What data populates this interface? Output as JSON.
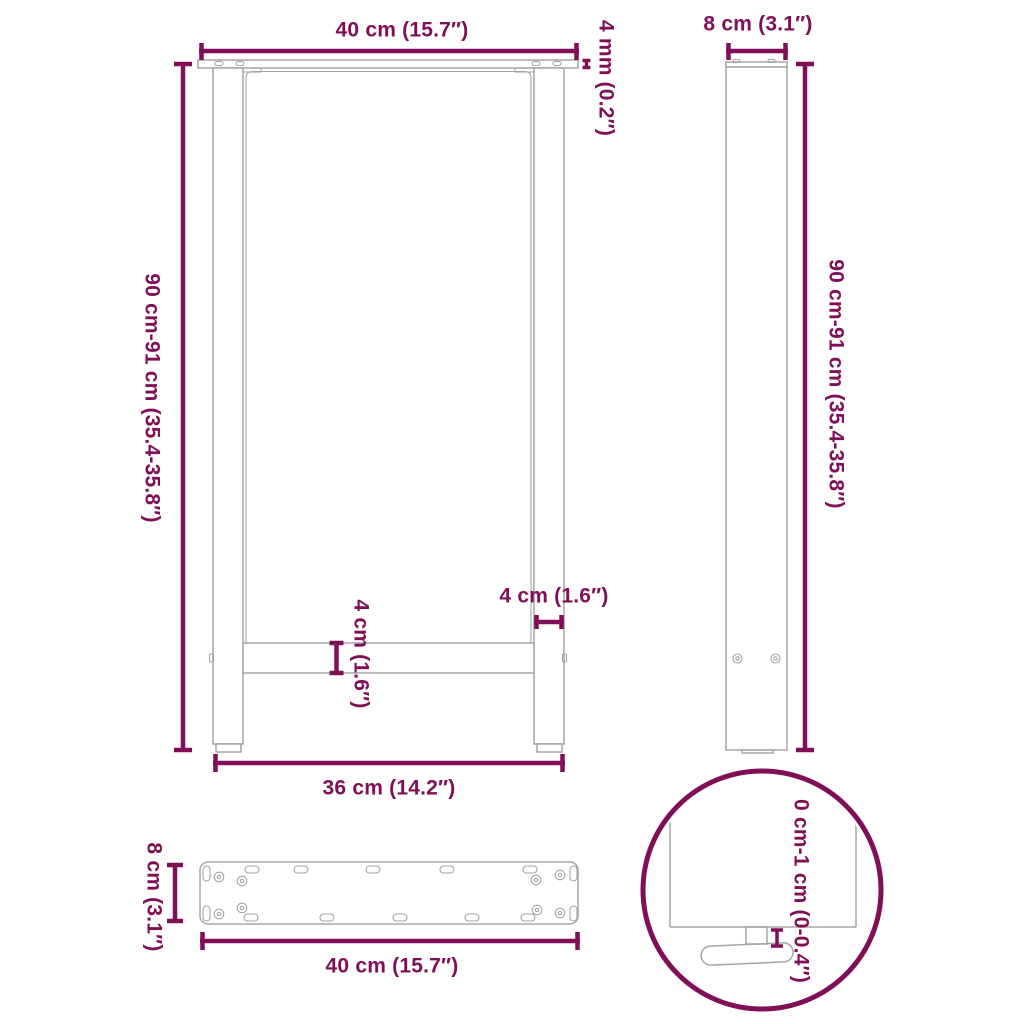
{
  "colors": {
    "accent": "#800F58",
    "outline": "#A5A5A5",
    "background": "#FFFFFF"
  },
  "views": {
    "front": {
      "labels": {
        "top_width": "40 cm (15.7″)",
        "plate_thickness": "4 mm (0.2″)",
        "height_range": "90 cm-91 cm (35.4-35.8″)",
        "leg_width": "4 cm (1.6″)",
        "crossbar_height": "4 cm (1.6″)",
        "bottom_width": "36 cm (14.2″)"
      }
    },
    "side": {
      "labels": {
        "depth": "8 cm (3.1″)",
        "height_range": "90 cm-91 cm (35.4-35.8″)"
      }
    },
    "mounting_plate": {
      "labels": {
        "depth": "8 cm (3.1″)",
        "width": "40 cm (15.7″)"
      }
    },
    "foot_detail": {
      "labels": {
        "adjustable_height": "0 cm-1 cm (0-0.4″)"
      }
    }
  }
}
